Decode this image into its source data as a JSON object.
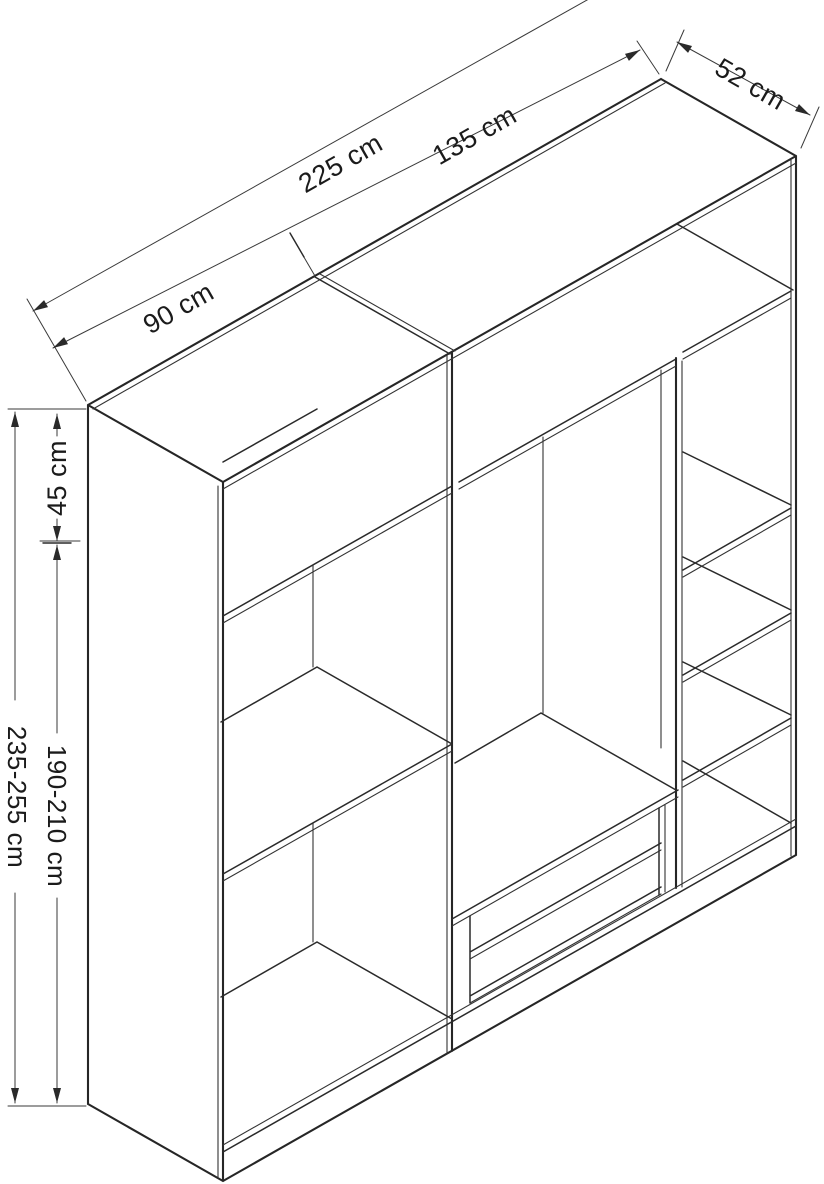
{
  "diagram": {
    "type": "furniture-dimension-drawing",
    "subject": "wardrobe with open shelves and drawers",
    "background": "#ffffff",
    "line_color": "#2a2a2a",
    "text_color": "#1b1b1b",
    "units": "cm",
    "dimensions": {
      "left_width": "90 cm",
      "total_width": "225 cm",
      "right_width": "135 cm",
      "depth": "52 cm",
      "top_section_height": "45 cm",
      "body_height": "190-210 cm",
      "total_height": "235-255 cm"
    }
  }
}
